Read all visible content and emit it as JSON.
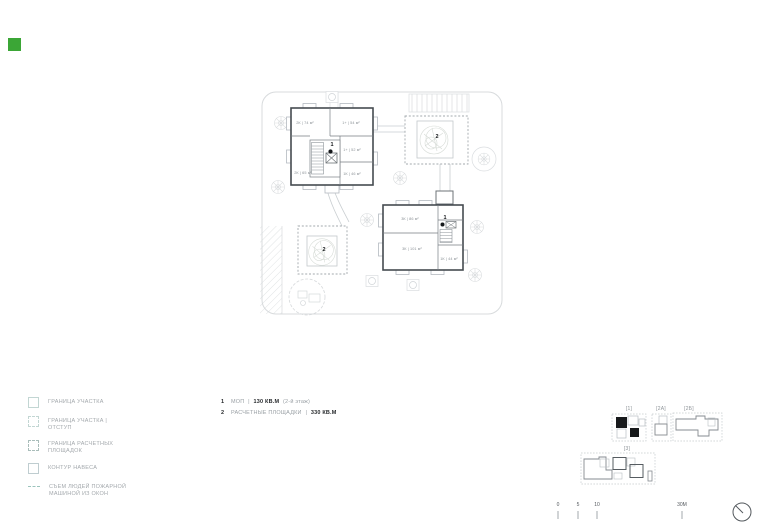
{
  "colors": {
    "accent_green": "#3ba636",
    "building_outline": "#454b50",
    "faint_line": "#d8dbdd",
    "text_gray": "#9aa0a5",
    "text_dark": "#26292c",
    "legend_symbol_teal": "#c2d6d3",
    "fire_line_teal": "#9cc4bd",
    "playground_dash": "#a3aaae"
  },
  "legend": {
    "items": [
      {
        "label": "ГРАНИЦА УЧАСТКА",
        "symbol": "solid-square"
      },
      {
        "label": "ГРАНИЦА УЧАСТКА | ОТСТУП",
        "symbol": "dashed-square"
      },
      {
        "label": "ГРАНИЦА РАСЧЕТНЫХ ПЛОЩАДОК",
        "symbol": "dashed-square-dark"
      },
      {
        "label": "КОНТУР НАВЕСА",
        "symbol": "solid-square"
      },
      {
        "label": "СЪЕМ ЛЮДЕЙ ПОЖАРНОЙ МАШИНОЙ ИЗ ОКОН",
        "symbol": "dashed-line"
      }
    ]
  },
  "notes": {
    "n1": {
      "num": "1",
      "label": "МОП",
      "sep": "|",
      "value": "130 КВ.М",
      "suffix": "(2-й этаж)"
    },
    "n2": {
      "num": "2",
      "label": "РАСЧЕТНЫЕ ПЛОЩАДКИ",
      "sep": "|",
      "value": "330 КВ.М"
    }
  },
  "plan": {
    "building_a": {
      "marker": "1",
      "rooms": [
        "2К | 74 м²",
        "1+ | 54 м²",
        "1+ | 52 м²",
        "2К | 65 м²",
        "1К | 46 м²"
      ]
    },
    "building_b": {
      "marker": "1",
      "rooms": [
        "3К | 86 м²",
        "3К | 101 м²",
        "1К | 44 м²"
      ]
    },
    "playground_top": {
      "marker": "2"
    },
    "playground_bottom": {
      "marker": "2"
    }
  },
  "keyplans": {
    "labels": [
      "[1]",
      "[2А]",
      "[2Б]",
      "[3]"
    ]
  },
  "scalebar": {
    "ticks": [
      "0",
      "5",
      "10",
      "30М"
    ]
  }
}
